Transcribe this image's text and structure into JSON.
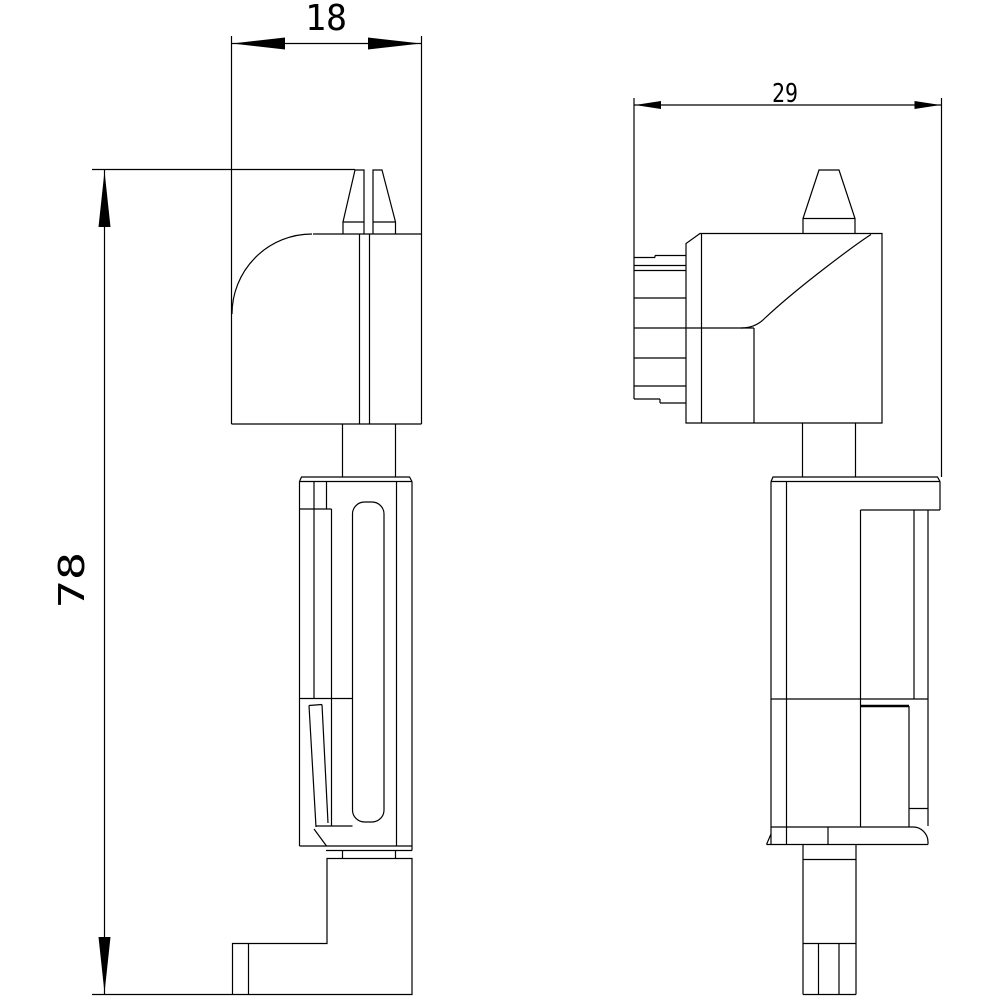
{
  "drawing": {
    "background_color": "#ffffff",
    "line_color": "#000000",
    "dimensions": {
      "front_width": "18",
      "front_height": "78",
      "side_depth": "29"
    }
  }
}
